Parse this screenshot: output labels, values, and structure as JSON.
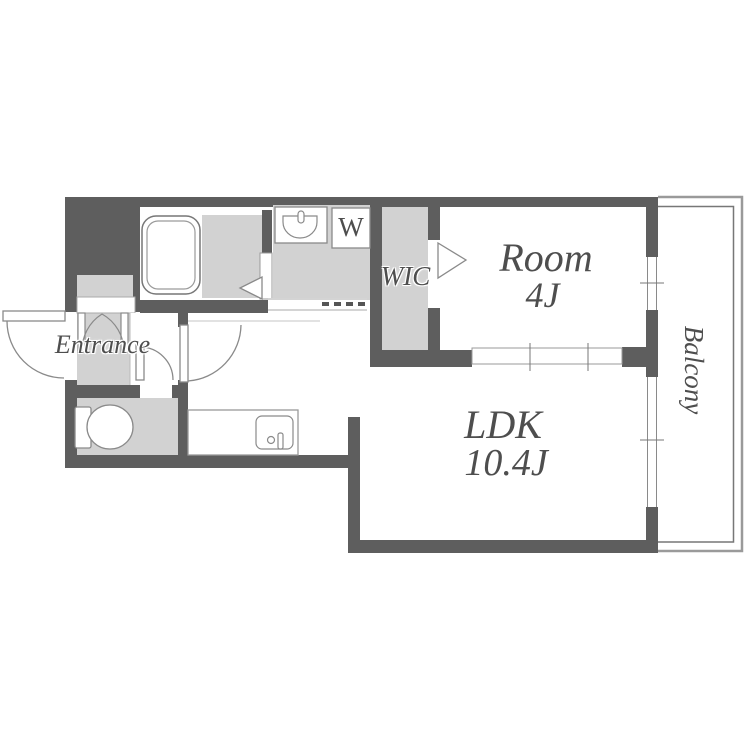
{
  "labels": {
    "entrance": "Entrance",
    "wic": "WIC",
    "room_name": "Room",
    "room_size": "4J",
    "ldk_name": "LDK",
    "ldk_size": "10.4J",
    "balcony": "Balcony",
    "washing_machine": "W"
  },
  "colors": {
    "wall": "#5e5e5e",
    "floor": "#d2d2d2",
    "outline": "#8a8a8a",
    "rail": "#9a9a9a",
    "text": "#4e4e4e"
  }
}
